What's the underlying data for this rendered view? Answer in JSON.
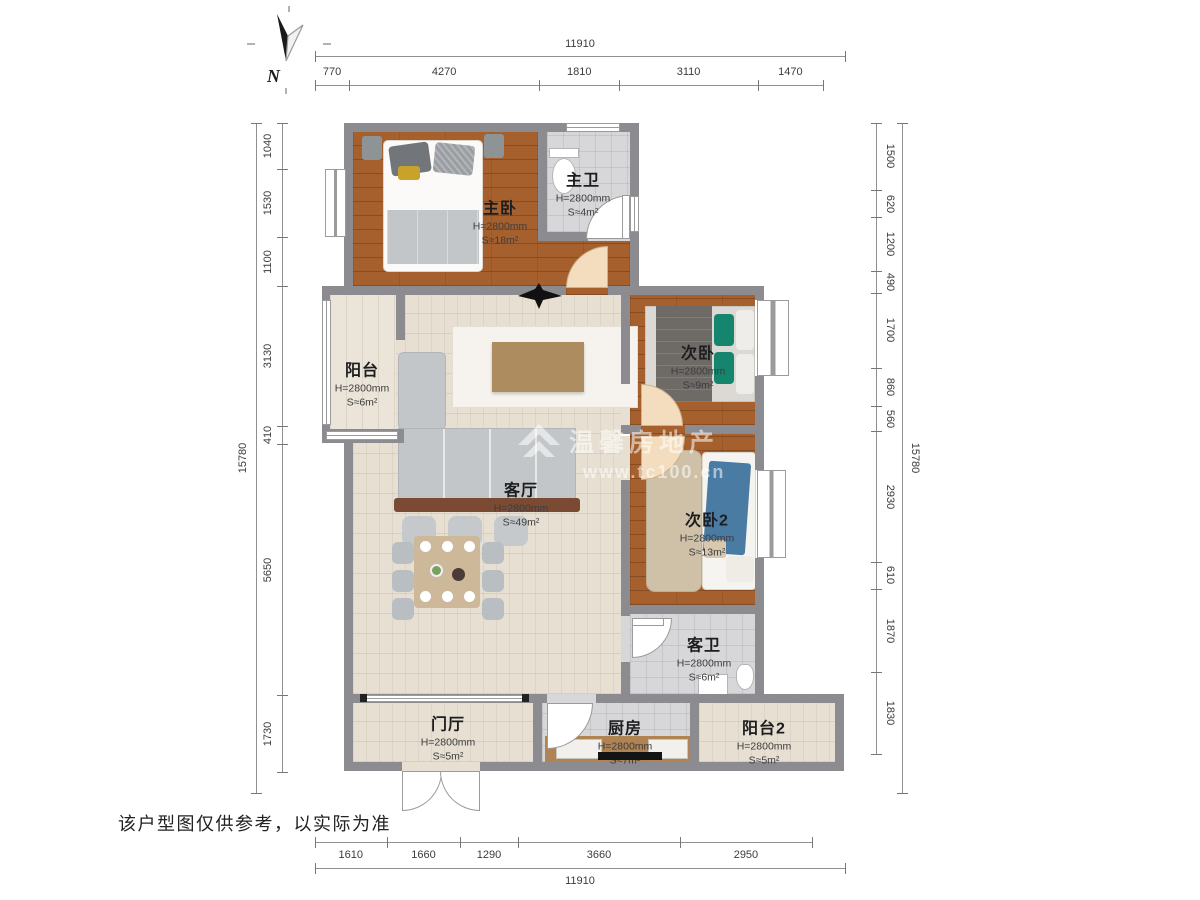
{
  "north_label": "N",
  "watermark": {
    "brand": "温馨房地产",
    "url": "www.tc100.cn"
  },
  "disclaimer": "该户型图仅供参考，以实际为准",
  "rooms": {
    "master_bedroom": {
      "name": "主卧",
      "height": "H=2800mm",
      "area": "S≈18m²"
    },
    "master_bath": {
      "name": "主卫",
      "height": "H=2800mm",
      "area": "S≈4m²"
    },
    "bedroom2": {
      "name": "次卧",
      "height": "H=2800mm",
      "area": "S≈9m²"
    },
    "bedroom3": {
      "name": "次卧2",
      "height": "H=2800mm",
      "area": "S≈13m²"
    },
    "living_room": {
      "name": "客厅",
      "height": "H=2800mm",
      "area": "S≈49m²"
    },
    "balcony": {
      "name": "阳台",
      "height": "H=2800mm",
      "area": "S≈6m²"
    },
    "guest_bath": {
      "name": "客卫",
      "height": "H=2800mm",
      "area": "S≈6m²"
    },
    "foyer": {
      "name": "门厅",
      "height": "H=2800mm",
      "area": "S≈5m²"
    },
    "kitchen": {
      "name": "厨房",
      "height": "H=2800mm",
      "area": "S≈7m²"
    },
    "balcony2": {
      "name": "阳台2",
      "height": "H=2800mm",
      "area": "S≈5m²"
    }
  },
  "dimensions": {
    "top": {
      "total": "11910",
      "segments": [
        770,
        4270,
        1810,
        3110,
        1470
      ]
    },
    "bottom": {
      "total": "11910",
      "segments": [
        1610,
        1660,
        1290,
        3660,
        2950
      ]
    },
    "left": {
      "total": "15780",
      "segments": [
        1040,
        1530,
        1100,
        3130,
        410,
        5650,
        1730
      ]
    },
    "right": {
      "total": "15780",
      "segments": [
        1500,
        620,
        1200,
        490,
        1700,
        860,
        560,
        2930,
        610,
        1870,
        1830
      ]
    }
  }
}
